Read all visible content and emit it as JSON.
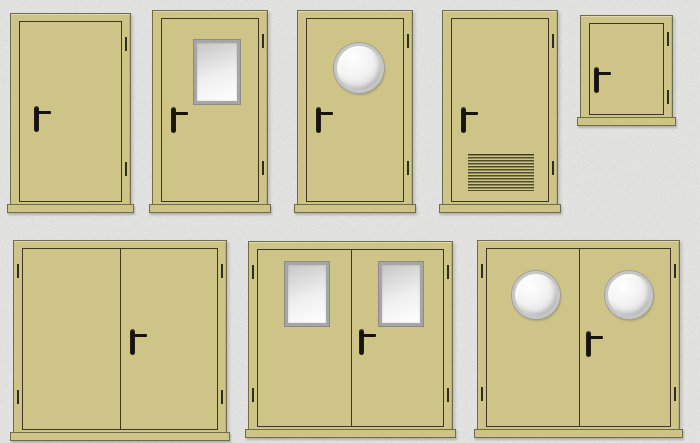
{
  "page": {
    "description": "Catalog sheet of technical metal doors shown as flat front-view illustrations on a mottled concrete-gray background",
    "rows": 2,
    "item_count": 8
  },
  "palette": {
    "background": "#e5e5e4",
    "door_fill": "#cfc488",
    "door_outline": "#3b3823",
    "frame_border": "#6f6c4c",
    "handle_color": "#17140e",
    "hinge_color": "#2f2d1c",
    "window_frame": "#a6a6a4",
    "window_frame_edge": "#8a8a88",
    "glass_from": "#c7c7c7",
    "glass_to": "#ffffff",
    "porthole_rim": "#c6c6c6",
    "grille_line": "#504d2d"
  },
  "items": [
    {
      "id": "single-plain",
      "label": "Single plain door, handle left, hinges right",
      "kind": "single",
      "leaf_count": 1,
      "feature": "none",
      "handle_side": "left",
      "hinge_side": "right"
    },
    {
      "id": "single-glazed",
      "label": "Single door with rectangular glazed window",
      "kind": "single",
      "leaf_count": 1,
      "feature": "rectangular-window",
      "handle_side": "left",
      "hinge_side": "right",
      "window_count": 1
    },
    {
      "id": "single-porthole",
      "label": "Single door with round porthole window",
      "kind": "single",
      "leaf_count": 1,
      "feature": "porthole",
      "handle_side": "left",
      "hinge_side": "right",
      "window_count": 1
    },
    {
      "id": "single-vented",
      "label": "Single door with ventilation grille at the bottom",
      "kind": "single",
      "leaf_count": 1,
      "feature": "ventilation-grille",
      "handle_side": "left",
      "hinge_side": "right"
    },
    {
      "id": "access-hatch",
      "label": "Square access hatch with handle left and hinges right",
      "kind": "hatch",
      "leaf_count": 1,
      "feature": "none",
      "handle_side": "left",
      "hinge_side": "right"
    },
    {
      "id": "double-plain",
      "label": "Double plain door, handle on right leaf at the meeting stile",
      "kind": "double",
      "leaf_count": 2,
      "feature": "none",
      "handle_side": "center-right-leaf",
      "hinge_side": "both"
    },
    {
      "id": "double-glazed",
      "label": "Double door with a rectangular glazed window in each leaf",
      "kind": "double",
      "leaf_count": 2,
      "feature": "rectangular-window",
      "handle_side": "center-right-leaf",
      "hinge_side": "both",
      "window_count": 2
    },
    {
      "id": "double-porthole",
      "label": "Double door with a round porthole window in each leaf",
      "kind": "double",
      "leaf_count": 2,
      "feature": "porthole",
      "handle_side": "center-right-leaf",
      "hinge_side": "both",
      "window_count": 2
    }
  ]
}
